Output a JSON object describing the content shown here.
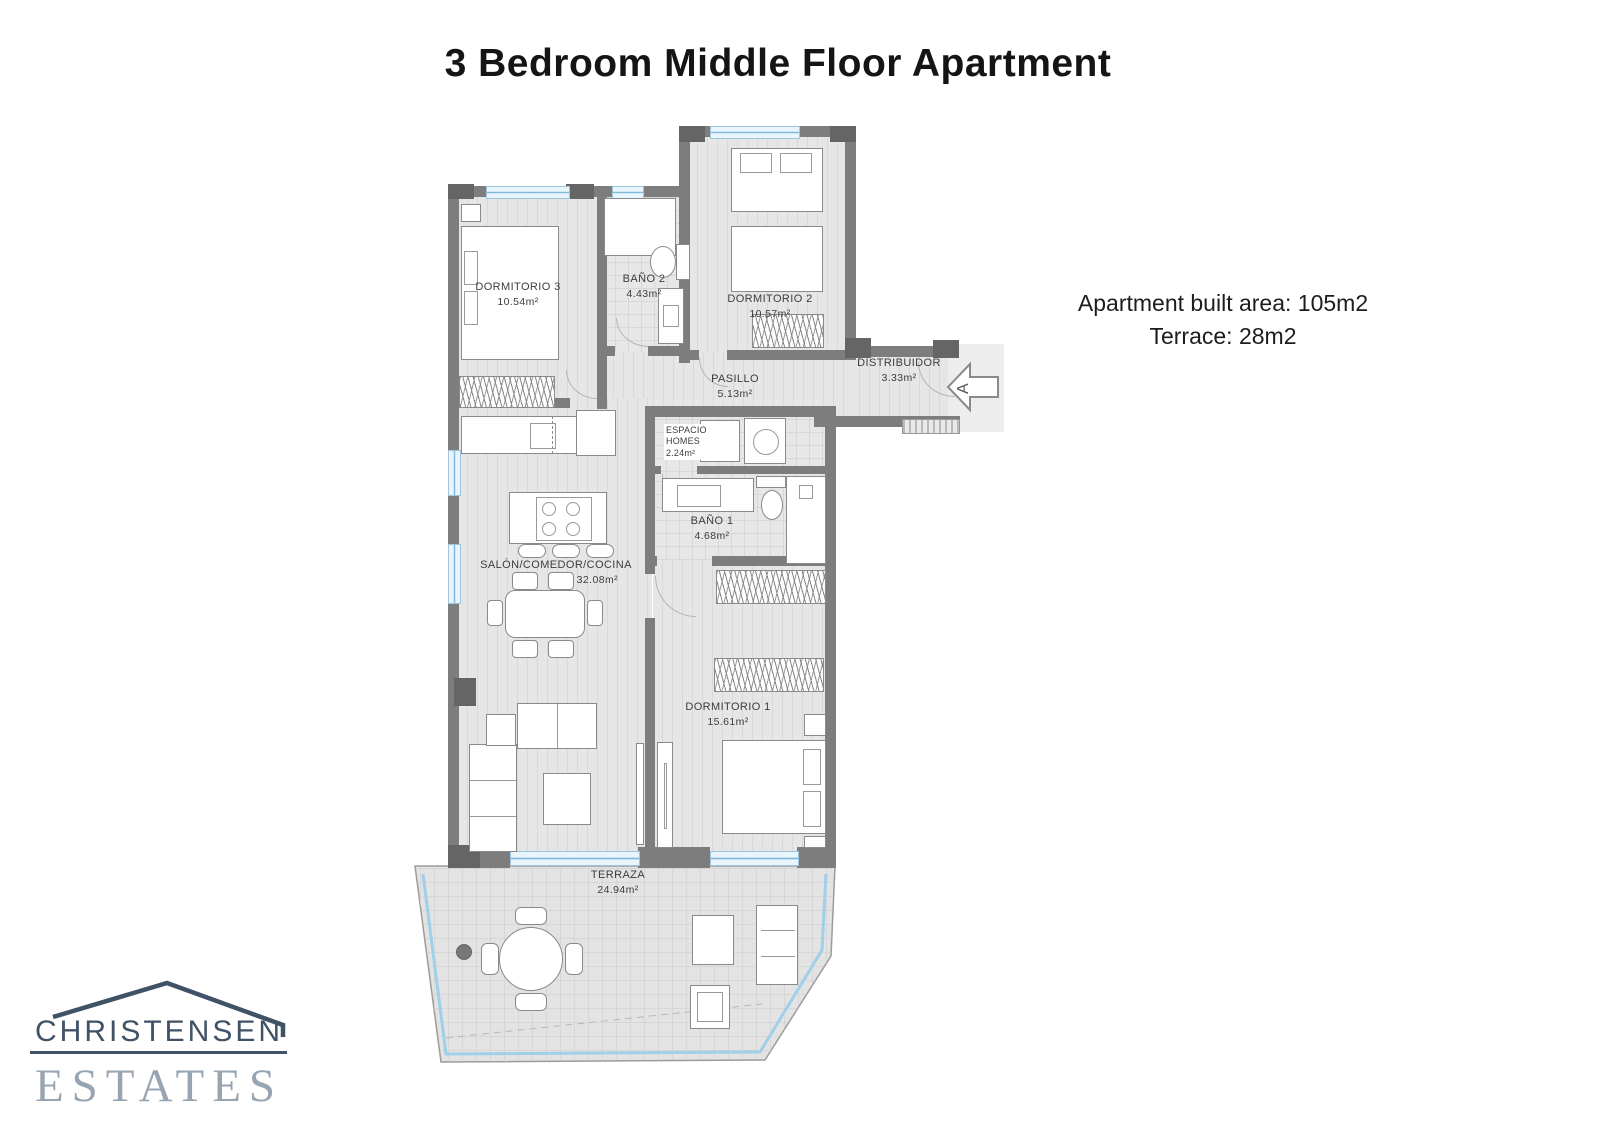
{
  "header": {
    "title": "3 Bedroom Middle Floor Apartment"
  },
  "info": {
    "built_area": "Apartment built area: 105m2",
    "terrace": "Terrace: 28m2"
  },
  "logo": {
    "name": "CHRISTENSEN",
    "sub": "ESTATES"
  },
  "entrance": {
    "letter": "A"
  },
  "rooms": {
    "dormitorio3": {
      "label": "DORMITORIO 3",
      "area": "10.54m²"
    },
    "bano2": {
      "label": "BAÑO 2",
      "area": "4.43m²"
    },
    "dormitorio2": {
      "label": "DORMITORIO 2",
      "area": "10.57m²"
    },
    "pasillo": {
      "label": "PASILLO",
      "area": "5.13m²"
    },
    "distribuidor": {
      "label": "DISTRIBUIDOR",
      "area": "3.33m²"
    },
    "espacio_homes": {
      "label1": "ESPACIO",
      "label2": "HOMES",
      "area": "2.24m²"
    },
    "bano1": {
      "label": "BAÑO 1",
      "area": "4.68m²"
    },
    "salon": {
      "label": "SALÓN/COMEDOR/COCINA",
      "area": "32.08m²"
    },
    "dormitorio1": {
      "label": "DORMITORIO 1",
      "area": "15.61m²"
    },
    "terraza": {
      "label": "TERRAZA",
      "area": "24.94m²"
    }
  },
  "colors": {
    "wall": "#7d7d7d",
    "window": "#cfe7f5",
    "logo_dark": "#3f5266",
    "logo_light": "#97a5b3"
  }
}
